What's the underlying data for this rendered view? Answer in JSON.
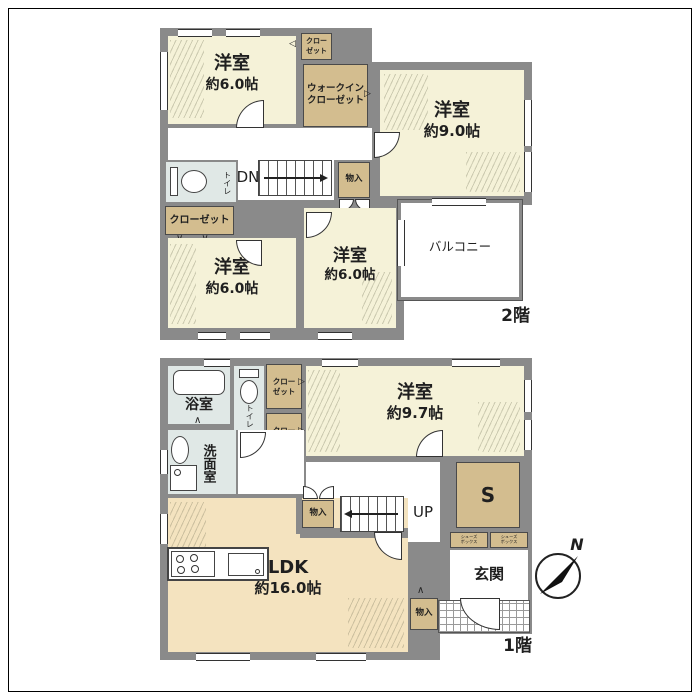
{
  "floor2": {
    "floor_label": "2階",
    "bedroom_nw": {
      "name": "洋室",
      "size": "約6.0帖"
    },
    "bedroom_e": {
      "name": "洋室",
      "size": "約9.0帖"
    },
    "bedroom_sw": {
      "name": "洋室",
      "size": "約6.0帖"
    },
    "bedroom_s": {
      "name": "洋室",
      "size": "約6.0帖"
    },
    "closet_top": {
      "line1": "クロー",
      "line2": "ゼット"
    },
    "walkin_closet": {
      "line1": "ウォークイン",
      "line2": "クローゼット"
    },
    "closet_left": {
      "label": "クローゼット"
    },
    "toilet": {
      "label": "トイレ"
    },
    "storage": {
      "label": "物入"
    },
    "stairs_label": "DN",
    "balcony": {
      "label": "バルコニー"
    }
  },
  "floor1": {
    "floor_label": "1階",
    "bath": {
      "label": "浴室"
    },
    "toilet": {
      "label": "トイレ"
    },
    "washroom": {
      "label": "洗面室"
    },
    "closet_a": {
      "line1": "クロー",
      "line2": "ゼット"
    },
    "closet_b": {
      "line1": "クロー",
      "line2": "ゼット"
    },
    "bedroom": {
      "name": "洋室",
      "size": "約9.7帖"
    },
    "ldk": {
      "name": "LDK",
      "size": "約16.0帖"
    },
    "storage_hall": {
      "label": "物入"
    },
    "storage_entry": {
      "label": "物入"
    },
    "stairs_label": "UP",
    "storage_s": {
      "label": "S"
    },
    "shoes_box_a": {
      "line1": "シューズ",
      "line2": "ボックス"
    },
    "shoes_box_b": {
      "line1": "シューズ",
      "line2": "ボックス"
    },
    "entrance": {
      "label": "玄関"
    }
  },
  "compass": {
    "north_label": "N"
  },
  "symbols": {
    "arrow_left": "◁",
    "arrow_right": "▷",
    "fold_up": "∧",
    "bifold": "∨∨"
  },
  "colors": {
    "wall": "#8a8a8a",
    "room": "#f5f2d8",
    "room_warm": "#f4e3bf",
    "closet_tan": "#d3bd8f",
    "wet_room": "#e0e8e6"
  }
}
